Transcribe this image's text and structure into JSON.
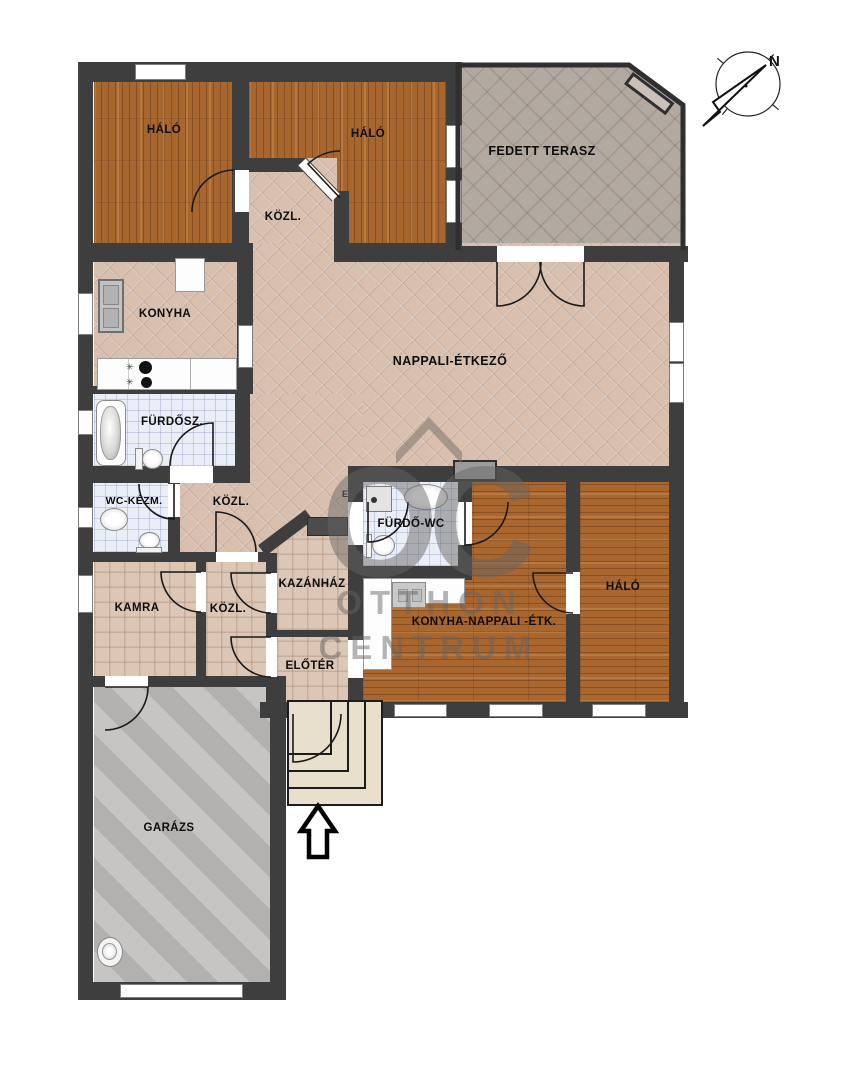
{
  "floorplan": {
    "title": "floor-plan",
    "rooms": [
      {
        "id": "halo-1",
        "label": "HÁLÓ"
      },
      {
        "id": "halo-2",
        "label": "HÁLÓ"
      },
      {
        "id": "kozl-upper",
        "label": "KÖZL."
      },
      {
        "id": "fedett-terasz",
        "label": "FEDETT TERASZ"
      },
      {
        "id": "konyha",
        "label": "KONYHA"
      },
      {
        "id": "nappali-etkezo",
        "label": "NAPPALI-ÉTKEZŐ"
      },
      {
        "id": "furdoszoba",
        "label": "FÜRDŐSZ."
      },
      {
        "id": "wc-kezmoso",
        "label": "WC-KÉZM."
      },
      {
        "id": "kozl-middle",
        "label": "KÖZL."
      },
      {
        "id": "furdo-wc",
        "label": "FÜRDŐ-WC"
      },
      {
        "id": "kamra",
        "label": "KAMRA"
      },
      {
        "id": "kozl-lower",
        "label": "KÖZL."
      },
      {
        "id": "kazanhaz",
        "label": "KAZÁNHÁZ"
      },
      {
        "id": "eloter",
        "label": "ELŐTÉR"
      },
      {
        "id": "konyha-nappali-etkezo",
        "label": "KONYHA-NAPPALI -ÉTK."
      },
      {
        "id": "halo-3",
        "label": "HÁLÓ"
      },
      {
        "id": "garazs",
        "label": "GARÁZS"
      }
    ],
    "watermark": {
      "letters": "OC",
      "line1": "OTTHON",
      "line2": "CENTRUM"
    },
    "compass": {
      "north_label": "N"
    },
    "colors": {
      "wall": "#3e3e3e",
      "wood_floor": "#a8662f",
      "tile_floor": "#d9c0ae",
      "bath_tile": "#eaeef6",
      "terrace_tile": "#b2a9a1",
      "garage_concrete": "#bcbab8"
    }
  }
}
